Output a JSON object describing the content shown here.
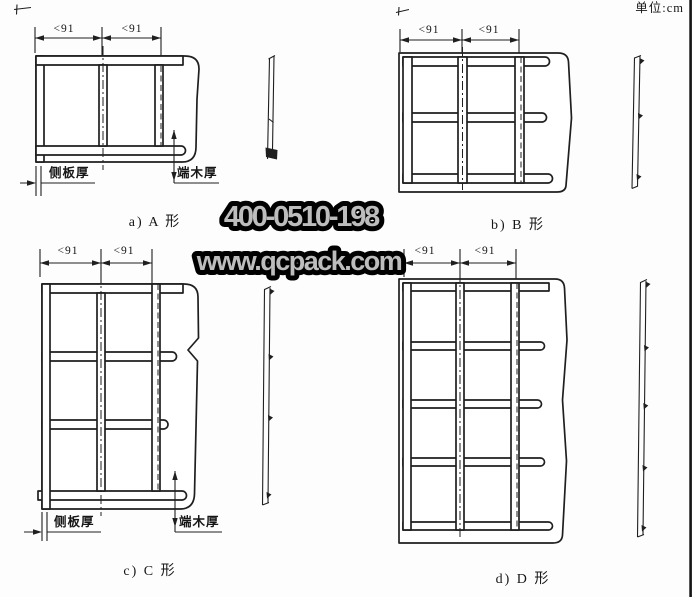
{
  "unit_label": "单位:cm",
  "watermarks": {
    "phone": "400-0510-198",
    "website": "www.qcpack.com"
  },
  "dimension_label": "<91",
  "thickness_labels": {
    "side_board": "侧板厚",
    "end_wood": "端木厚"
  },
  "diagrams": {
    "a": {
      "caption": "a) A 形"
    },
    "b": {
      "caption": "b) B 形"
    },
    "c": {
      "caption": "c) C 形"
    },
    "d": {
      "caption": "d) D 形"
    }
  },
  "colors": {
    "line": "#1f1f1f",
    "watermark_fill": "#bdbdbd",
    "watermark_outline": "#000000"
  }
}
